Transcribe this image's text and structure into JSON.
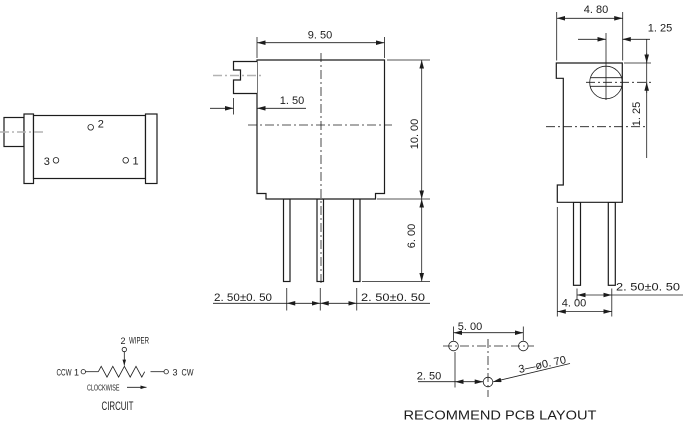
{
  "left_view": {
    "pin2": "2",
    "pin3": "3",
    "pin1": "1"
  },
  "front_view": {
    "width": "9. 50",
    "shaft_len": "1. 50",
    "height": "10. 00",
    "pin_len": "6. 00",
    "pitch_left": "2. 50±0. 50",
    "pitch_right": "2. 50±0. 50"
  },
  "right_view": {
    "depth": "4. 80",
    "screw_offset_h": "1. 25",
    "screw_offset_v": "1. 25",
    "pitch": "2. 50±0. 50",
    "base": "4. 00"
  },
  "circuit": {
    "pin2": "2",
    "wiper": "WIPER",
    "ccw": "CCW",
    "pin1": "1",
    "pin3": "3",
    "cw": "CW",
    "rotation": "CLOCKWISE",
    "caption": "CIRCUIT"
  },
  "pcb": {
    "pitch": "5. 00",
    "offset": "2. 50",
    "holes": "3—ø0. 70",
    "caption": "RECOMMEND PCB LAYOUT"
  },
  "colors": {
    "line": "#1c1c1c",
    "centerline_gray": "#b3b3b3",
    "background": "#ffffff"
  }
}
